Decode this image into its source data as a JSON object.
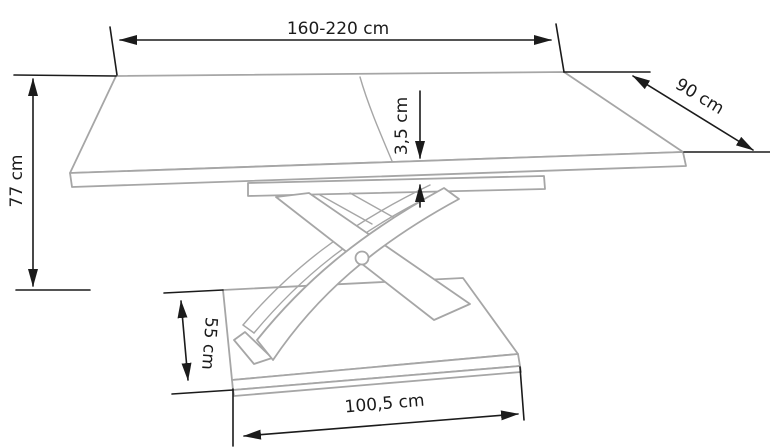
{
  "diagram": {
    "subject": "extendable-pedestal-table-dimension-drawing",
    "units": "cm",
    "colors": {
      "outline": "#a6a6a6",
      "dimension": "#1b1b1b",
      "background": "#ffffff"
    },
    "dimensions": [
      {
        "id": "length",
        "label": "160-220 cm",
        "value": "160-220",
        "orientation": "horizontal"
      },
      {
        "id": "depth",
        "label": "90 cm",
        "value": "90",
        "orientation": "diagonal"
      },
      {
        "id": "height",
        "label": "77 cm",
        "value": "77",
        "orientation": "vertical"
      },
      {
        "id": "top-thickness",
        "label": "3,5 cm",
        "value": "3,5",
        "orientation": "vertical"
      },
      {
        "id": "base-depth",
        "label": "55 cm",
        "value": "55",
        "orientation": "vertical"
      },
      {
        "id": "base-length",
        "label": "100,5 cm",
        "value": "100,5",
        "orientation": "horizontal"
      }
    ]
  }
}
